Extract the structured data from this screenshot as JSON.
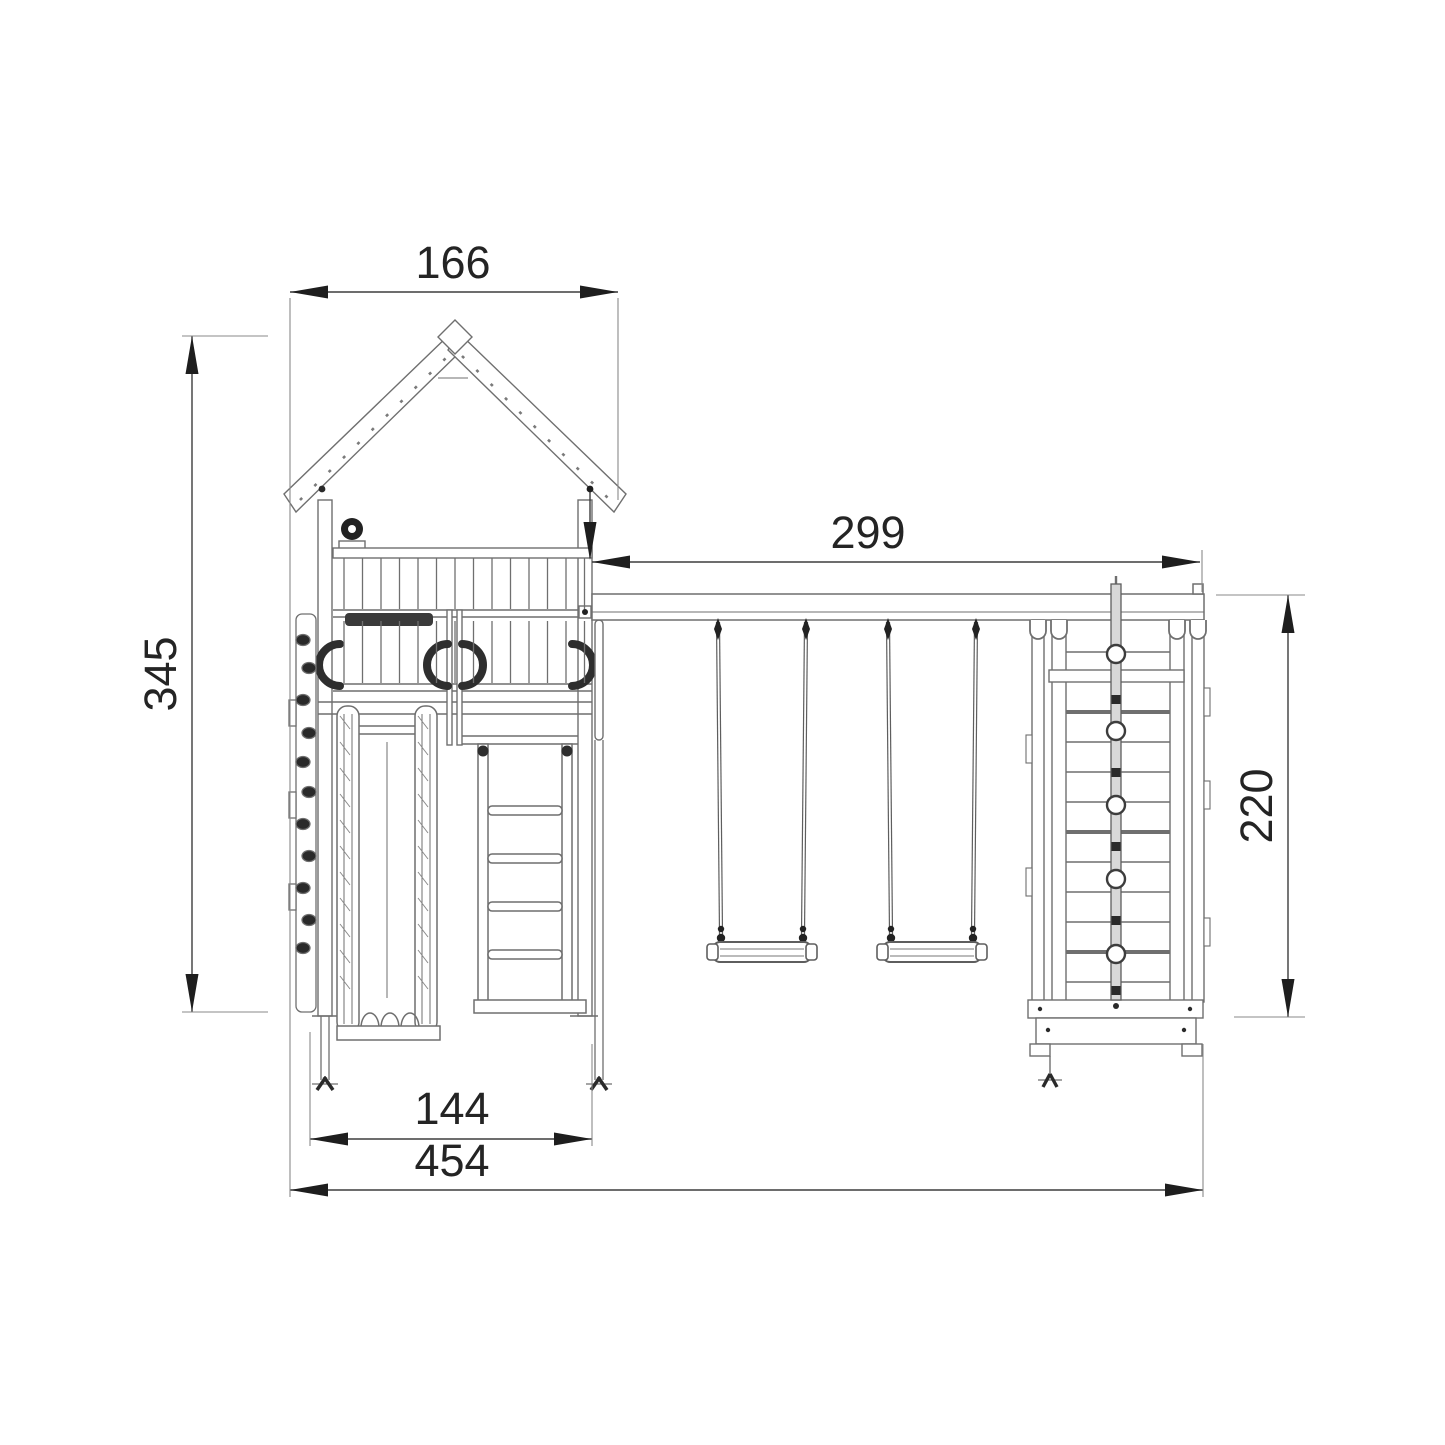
{
  "diagram": {
    "kind": "dimensioned elevation drawing",
    "subject": "playground tower with roof, slide, ladder, climbing holds, double swing beam and climbing frame",
    "dimensions": {
      "roof_width": {
        "value": "166",
        "orientation": "horizontal"
      },
      "swing_beam_length": {
        "value": "299",
        "orientation": "horizontal"
      },
      "overall_height": {
        "value": "345",
        "orientation": "vertical"
      },
      "climbing_frame_height": {
        "value": "220",
        "orientation": "vertical"
      },
      "tower_base_width": {
        "value": "144",
        "orientation": "horizontal"
      },
      "overall_width": {
        "value": "454",
        "orientation": "horizontal"
      }
    },
    "colors": {
      "background": "#ffffff",
      "line": "#6f6f6f",
      "dimension_line": "#3d3d3d",
      "arrow": "#1e1e1e",
      "text": "#242424",
      "dark_fill": "#2a2a2a"
    }
  }
}
